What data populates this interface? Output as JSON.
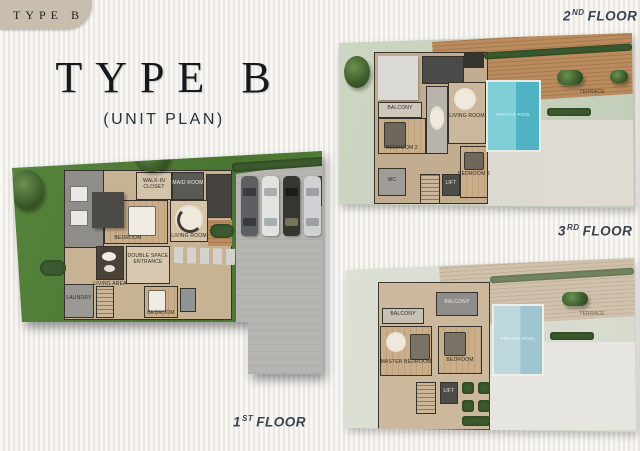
{
  "badge": {
    "label": "TYPE B"
  },
  "title": {
    "main": "TYPE B",
    "sub": "(UNIT PLAN)"
  },
  "colors": {
    "lawn_green": "#4f7c39",
    "lawn_pale": "#c9d4c0",
    "lawn_faded": "#dde1d6",
    "pool_teal": "#5fc1cc",
    "pool_faded": "#b5d4da",
    "deck_wood": "#b08257",
    "deck_faded": "#cfc0ab",
    "driveway_gray": "#b3b2b0",
    "badge_beige": "#c7beae",
    "floor_label_color": "#3a4350"
  },
  "floors": {
    "first": {
      "num": "1",
      "ord": "ST",
      "word": "FLOOR",
      "rooms": {
        "maid": "MAID ROOM",
        "closet": "WALK-IN CLOSET",
        "bedroom": "BEDROOM",
        "living_room": "LIVING ROOM",
        "living_area": "LIVING AREA",
        "entrance": "DOUBLE SPACE ENTRANCE",
        "laundry": "LAUNDRY",
        "bedroom_south": "BEDROOM"
      }
    },
    "second": {
      "num": "2",
      "ord": "ND",
      "word": "FLOOR",
      "rooms": {
        "balcony": "BALCONY",
        "bedroom2": "BEDROOM 2",
        "living_room": "LIVING ROOM",
        "wc": "WC",
        "lift": "LIFT",
        "bedroom3": "BEDROOM 3",
        "pool": "PRIVATE POOL",
        "terrace": "TERRACE"
      }
    },
    "third": {
      "num": "3",
      "ord": "RD",
      "word": "FLOOR",
      "rooms": {
        "balcony_a": "BALCONY",
        "balcony_b": "BALCONY",
        "master": "MASTER BEDROOM",
        "bedroom": "BEDROOM",
        "lift": "LIFT",
        "pool": "PRIVATE POOL",
        "terrace": "TERRACE"
      }
    }
  }
}
